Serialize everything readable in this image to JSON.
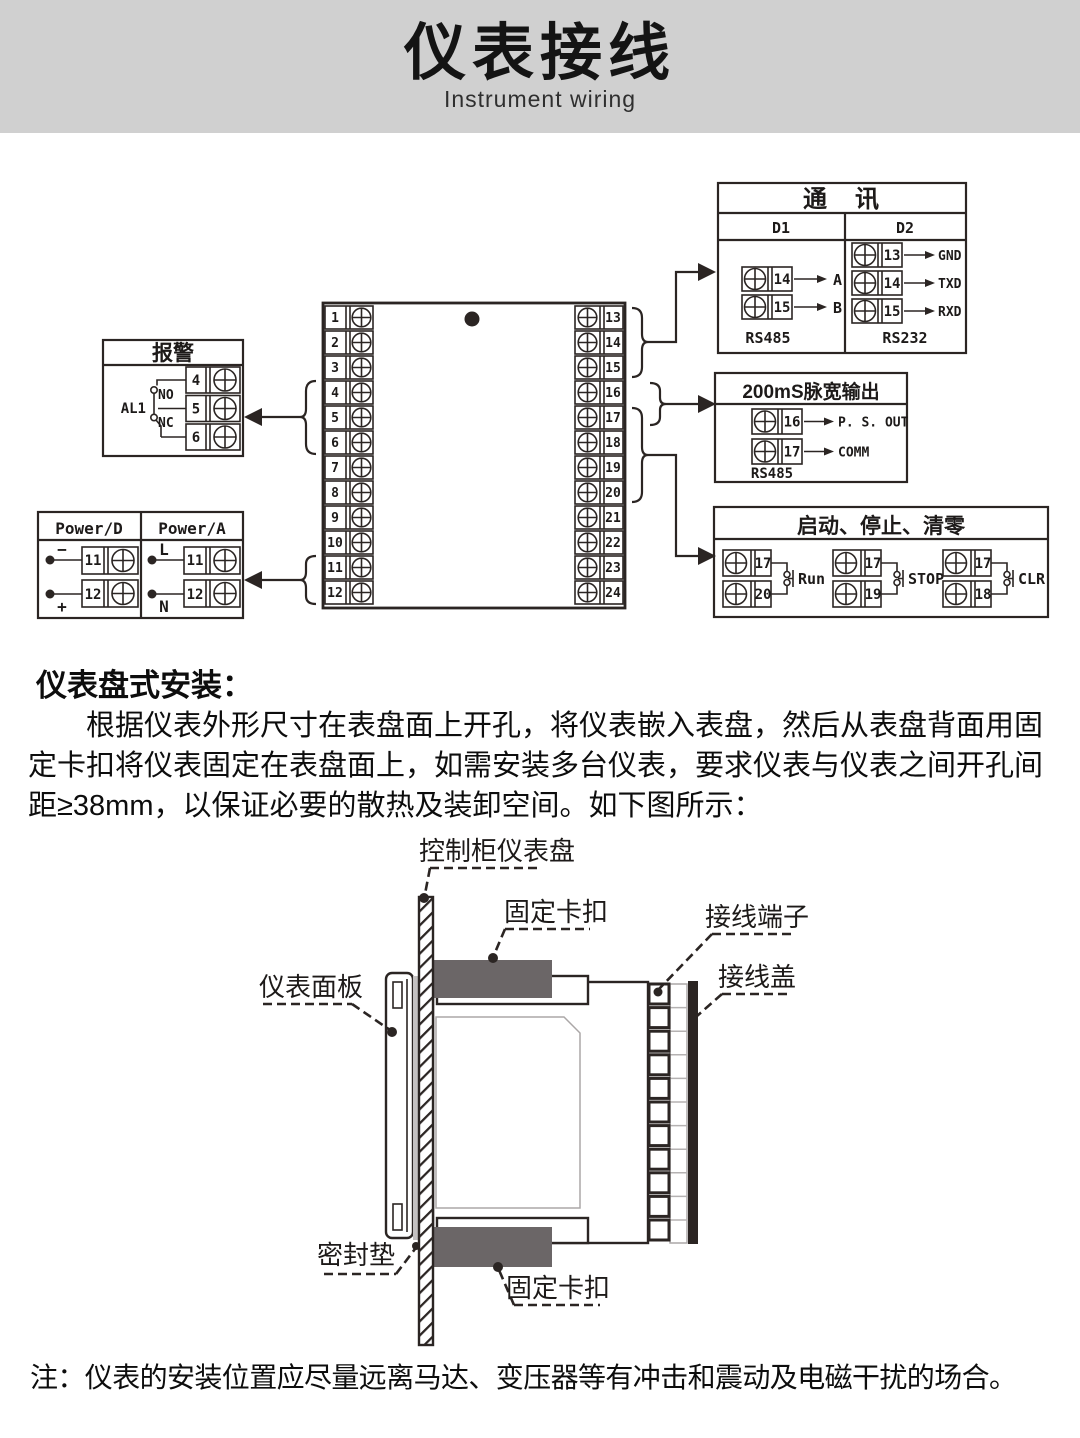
{
  "header": {
    "title": "仪表接线",
    "subtitle": "Instrument wiring"
  },
  "comm_box": {
    "title": "通　讯",
    "col1": "D1",
    "col2": "D2",
    "d1_terminals": [
      {
        "num": "14",
        "label": "A"
      },
      {
        "num": "15",
        "label": "B"
      }
    ],
    "d1_footer": "RS485",
    "d2_terminals": [
      {
        "num": "13",
        "label": "GND"
      },
      {
        "num": "14",
        "label": "TXD"
      },
      {
        "num": "15",
        "label": "RXD"
      }
    ],
    "d2_footer": "RS232"
  },
  "alarm_box": {
    "title": "报警",
    "relay": "AL1",
    "no": "NO",
    "nc": "NC",
    "terminals": [
      "4",
      "5",
      "6"
    ]
  },
  "power_box": {
    "col1": "Power/D",
    "col2": "Power/A",
    "d_rows": [
      {
        "sign": "−",
        "num": "11"
      },
      {
        "sign": "+",
        "num": "12"
      }
    ],
    "a_rows": [
      {
        "sign": "L",
        "num": "11"
      },
      {
        "sign": "N",
        "num": "12"
      }
    ]
  },
  "pulse_box": {
    "title": "200mS脉宽输出",
    "terminals": [
      {
        "num": "16",
        "label": "P. S. OUT"
      },
      {
        "num": "17",
        "label": "COMM"
      }
    ],
    "footer": "RS485"
  },
  "control_box": {
    "title": "启动、停止、清零",
    "groups": [
      {
        "top": "17",
        "bottom": "20",
        "label": "Run"
      },
      {
        "top": "17",
        "bottom": "19",
        "label": "STOP"
      },
      {
        "top": "17",
        "bottom": "18",
        "label": "CLR"
      }
    ]
  },
  "main_block": {
    "left": [
      "1",
      "2",
      "3",
      "4",
      "5",
      "6",
      "7",
      "8",
      "9",
      "10",
      "11",
      "12"
    ],
    "right": [
      "13",
      "14",
      "15",
      "16",
      "17",
      "18",
      "19",
      "20",
      "21",
      "22",
      "23",
      "24"
    ]
  },
  "install": {
    "heading": "仪表盘式安装：",
    "paragraph": "根据仪表外形尺寸在表盘面上开孔，将仪表嵌入表盘，然后从表盘背面用固定卡扣将仪表固定在表盘面上，如需安装多台仪表，要求仪表与仪表之间开孔间距≥38mm，以保证必要的散热及装卸空间。如下图所示：",
    "labels": {
      "panel": "控制柜仪表盘",
      "clip_top": "固定卡扣",
      "terminal": "接线端子",
      "cover": "接线盖",
      "faceplate": "仪表面板",
      "gasket": "密封垫",
      "clip_bottom": "固定卡扣"
    }
  },
  "note": "注：仪表的安装位置应尽量远离马达、变压器等有冲击和震动及电磁干扰的场合。",
  "colors": {
    "line": "#2b2523",
    "clip_gray": "#6b6667",
    "header_gray": "#d0d0d0"
  }
}
